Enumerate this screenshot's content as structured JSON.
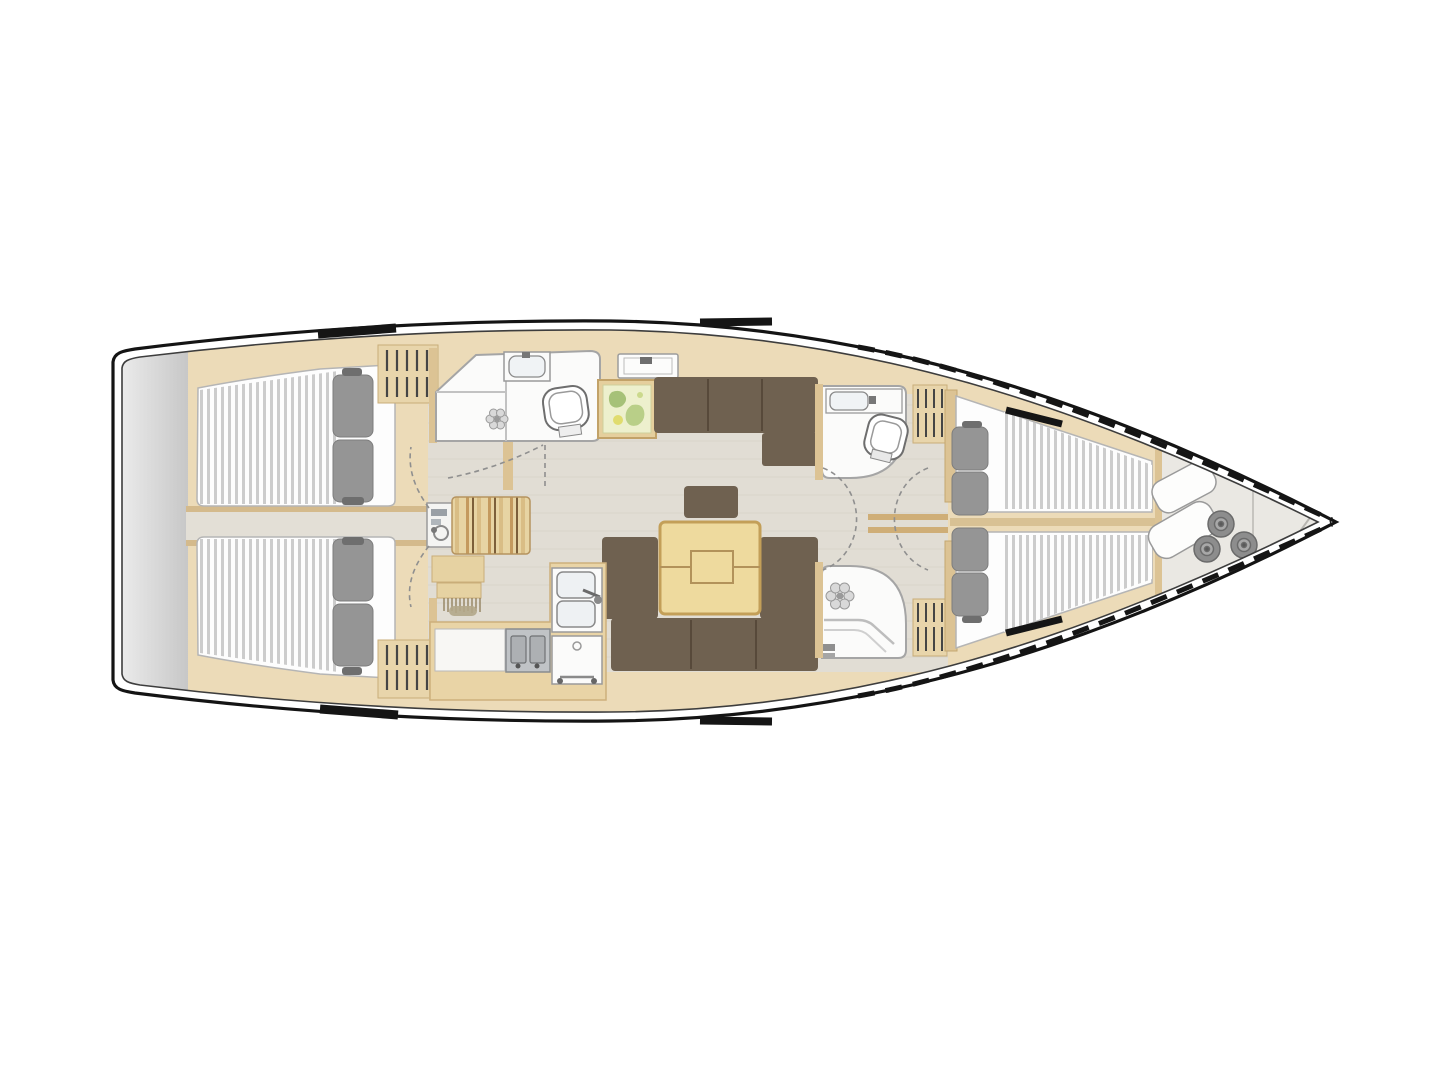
{
  "meta": {
    "type": "yacht-interior-floor-plan",
    "view": "top-down",
    "orientation": "bow-right"
  },
  "palette": {
    "background": "#ffffff",
    "hull_line": "#141414",
    "inner_line": "#3d3d3d",
    "wood_light": "#ecdbb8",
    "wood_counter": "#e9d4a6",
    "wood_wall": "#dcc394",
    "wood_edge": "#c9ad79",
    "floor": "#e1ddd4",
    "floor_line": "#d6d1c6",
    "corridor": "#e3dfd6",
    "room_white": "#fbfbfa",
    "room_outline": "#a5a5a5",
    "mattress_white": "#fdfdfd",
    "mattress_stripe": "#cccccc",
    "pillow_gray": "#959595",
    "sofa_brown": "#6f6150",
    "sofa_seam": "#57493a",
    "table_wood": "#eeda9e",
    "table_edge": "#c39f58",
    "seat_tan": "#e7d4a3",
    "transom_gray_light": "#f1f1f1",
    "transom_gray_dark": "#c7c7c7",
    "locker_gray": "#eae8e3",
    "fender_gray": "#8d8d8d",
    "appliance_gray": "#c0c3c6",
    "map_yellow": "#edf0cd",
    "map_green": "#a6c178",
    "louver_dark": "#454545",
    "arc_gray": "#8f8f8f"
  },
  "features": {
    "hull": "sailing-yacht-hull-top-view",
    "areas": [
      "swim-platform",
      "aft-cabin-port",
      "aft-cabin-starboard",
      "companionway-corridor",
      "aft-head-port",
      "nav-station",
      "galley",
      "saloon",
      "dinette-table",
      "forward-head",
      "forward-shower",
      "owner-cabin-v-berth",
      "sail-locker-bow"
    ],
    "objects": [
      "double-berth-mattress",
      "pillows",
      "wardrobe-louvers",
      "toilet",
      "washbasin",
      "shower-drain",
      "double-sink",
      "stove",
      "oven",
      "chart-picture",
      "deck-hatch",
      "l-sofa",
      "u-sofa",
      "sail-bags",
      "fenders",
      "door-swing-arcs"
    ]
  }
}
